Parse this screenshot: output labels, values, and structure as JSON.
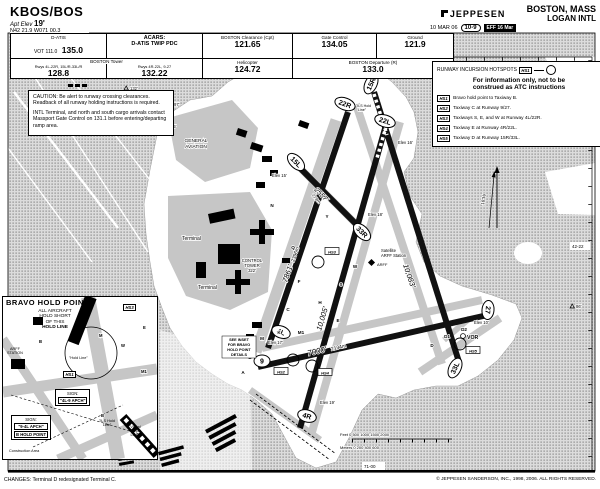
{
  "header": {
    "icao": "KBOS/BOS",
    "apt_elev_label": "Apt Elev",
    "apt_elev": "19'",
    "coords": "N42 21.9 W071 00.3",
    "brand": "JEPPESEN",
    "date": "10 MAR 06",
    "index": "10-9",
    "eff_badge": "EFF 16 Mar",
    "city": "BOSTON, MASS",
    "airport": "LOGAN INTL"
  },
  "comms": {
    "datis_label": "D-ATIS",
    "datis_vot": "VOT 111.0",
    "datis_freq": "135.0",
    "acars_label": "ACARS:",
    "acars_value": "D-ATIS TWIP PDC",
    "clearance_label": "BOSTON Clearance (Cpt)",
    "clearance_freq": "121.65",
    "gate_label": "Gate Control",
    "gate_freq": "134.05",
    "ground_label": "Ground",
    "ground_freq": "121.9",
    "tower_label": "BOSTON Tower",
    "tower_rwys_1": "Rwys 4L-22R, 15L/R-33L/R",
    "tower_freq_1": "128.8",
    "tower_rwys_2": "Rwys 4R-22L, 9-27",
    "tower_freq_2": "132.22",
    "heli_label": "Helicopter",
    "heli_freq": "124.72",
    "dep_label": "BOSTON Departure (R)",
    "dep_freq": "133.0"
  },
  "caution": {
    "text_1": "CAUTION: Be alert to runway crossing clearances. Readback of all runway holding instructions is required.",
    "text_2": "INTL Terminal, and north and south cargo arrivals contact Massport Gate Control on 131.1 before entering/departing ramp area."
  },
  "hotspots": {
    "title": "RUNWAY INCURSION HOTSPOTS",
    "symbol": "HS1",
    "note_1": "For information only, not to be",
    "note_2": "construed as ATC instructions",
    "items": [
      {
        "id": "HS1",
        "text": "Bravo hold point to Taxiway B."
      },
      {
        "id": "HS2",
        "text": "Taxiway C at Runway 9/27."
      },
      {
        "id": "HS3",
        "text": "Taxiways S, E, and W at Runway 4L/22R."
      },
      {
        "id": "HS4",
        "text": "Taxiway E at Runway 4R/22L."
      },
      {
        "id": "HS5",
        "text": "Taxiway D at Runway 15R/33L."
      }
    ]
  },
  "inset": {
    "title": "BRAVO HOLD POINT",
    "note_1": "ALL AIRCRAFT",
    "note_2": "HOLD SHORT",
    "note_3": "OF THIS",
    "note_4": "HOLD LINE",
    "badge_hs3": "HS3",
    "badge_hs1": "HS1",
    "arff_1": "ARFF",
    "arff_2": "STATION",
    "hold_line": "\"Hold Line\"",
    "sign1_l1": "SIGN:",
    "sign1_l2": "\"4L-9 APCH\"",
    "sign2_l1": "SIGN:",
    "sign2_l2": "\"9-4L APCH\"",
    "b_hold": "B HOLD POINT",
    "ils_hold_1": "\"ILS Hold",
    "ils_hold_2": "Line\"",
    "vis_hold_1": "\"Visual",
    "vis_hold_2": "Hold",
    "vis_hold_3": "Line\"",
    "construction": "Construction Area",
    "twy_b1": "B",
    "twy_w": "W",
    "twy_e": "E",
    "twy_m": "M",
    "twy_m1": "M1",
    "twy_b2": "B"
  },
  "chart": {
    "rwy_4l": "4L",
    "rwy_22r": "22R",
    "rwy_4r": "4R",
    "rwy_22l": "22L",
    "rwy_9": "9",
    "rwy_27": "27",
    "rwy_15r": "15R",
    "rwy_33l": "33L",
    "rwy_15l": "15L",
    "rwy_33r": "33R",
    "len_4l": "7861'",
    "len_4l_m": "2396m",
    "len_4r": "10,005'",
    "len_927": "7000'",
    "len_927_m": "2134m",
    "len_15l": "2557'",
    "len_15l_m": "779m",
    "len_15r": "10,083'",
    "elev_15l": "Elev 15'",
    "elev_33r": "Elev 18'",
    "elev_9": "Elev 17'",
    "elev_4r": "Elev 19'",
    "elev_27": "Elev 10'",
    "elev_22l": "Elev 16'",
    "general_aviation_1": "GENERAL",
    "general_aviation_2": "AVIATION",
    "terminal_1": "Terminal",
    "terminal_2": "Terminal",
    "control_tower_1": "CONTROL",
    "control_tower_2": "TOWER",
    "control_tower_3": "322'",
    "arff_sat_1": "Satellite",
    "arff_sat_2": "ARFF Station",
    "arff": "ARFF",
    "vor": "VOR",
    "magvar": "16°W",
    "see_inset_1": "SEE INSET",
    "see_inset_2": "FOR BRAVO",
    "see_inset_3": "HOLD POINT",
    "see_inset_4": "DETAILS",
    "ils_hold_1": "\"ILS Hold",
    "ils_hold_2": "Line\"",
    "obst_97": "97'",
    "obst_85": "85'",
    "obst_86": "86'",
    "obst_132": "132'",
    "lon_top": "71-00",
    "lon_bottom": "71-00",
    "lat_1": "42-23",
    "lat_2": "42-22",
    "hs2": "HS2",
    "hs3": "HS3",
    "hs4": "HS4",
    "hs5": "HS5",
    "scale_feet": "Feet 0       500      1000     1500     2000",
    "scale_meters": "Meters 0      200      400      600",
    "twy": [
      "N",
      "Y",
      "Q",
      "F",
      "C",
      "H",
      "E",
      "K",
      "M",
      "B",
      "W",
      "S",
      "D",
      "A",
      "D1",
      "D2",
      "M1"
    ],
    "colors": {
      "water_dot": "#a2a2a2",
      "water_bg": "#dcdcdc",
      "taxiway": "#c6c6c6",
      "runway": "#111111"
    }
  },
  "footer": {
    "changes": "CHANGES: Terminal D redesignated Terminal C.",
    "copyright": "© JEPPESEN SANDERSON, INC., 1998, 2006. ALL RIGHTS RESERVED."
  }
}
